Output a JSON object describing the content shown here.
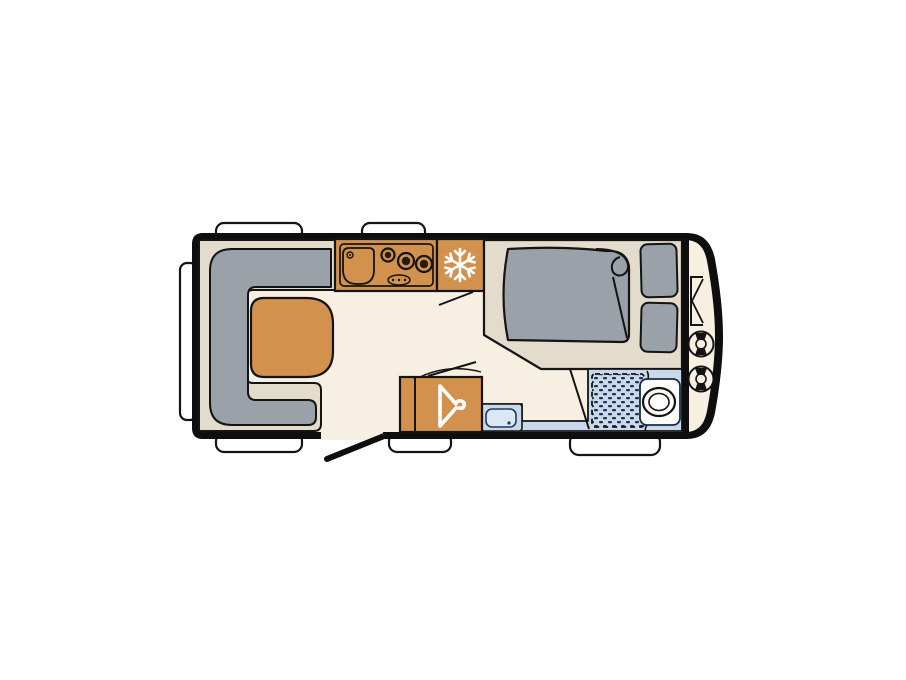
{
  "diagram": {
    "type": "caravan-floor-plan",
    "rooms": [
      "lounge",
      "kitchen",
      "fridge",
      "bedroom",
      "bathroom",
      "wardrobe",
      "gas-locker"
    ],
    "icons": {
      "fridge": "snowflake-icon",
      "wardrobe": "hanger-icon",
      "entry": "open-door-line",
      "gas_locker": "gas-bottles"
    }
  },
  "colors": {
    "outline": "#0e0e0e",
    "stroke": "#141414",
    "floor": "#F7EFE2",
    "base": "#E3DBCC",
    "cushion": "#9BA1A8",
    "wood": "#D2914C",
    "wet_floor": "#C9D9EC",
    "basin_inner": "#DAE7F5",
    "shower_dash": "#22304A",
    "window_white": "#FFFFFF",
    "icon_white": "#FFFFFF",
    "burner_dark": "#241A10",
    "toilet_white": "#FDFDFB"
  }
}
